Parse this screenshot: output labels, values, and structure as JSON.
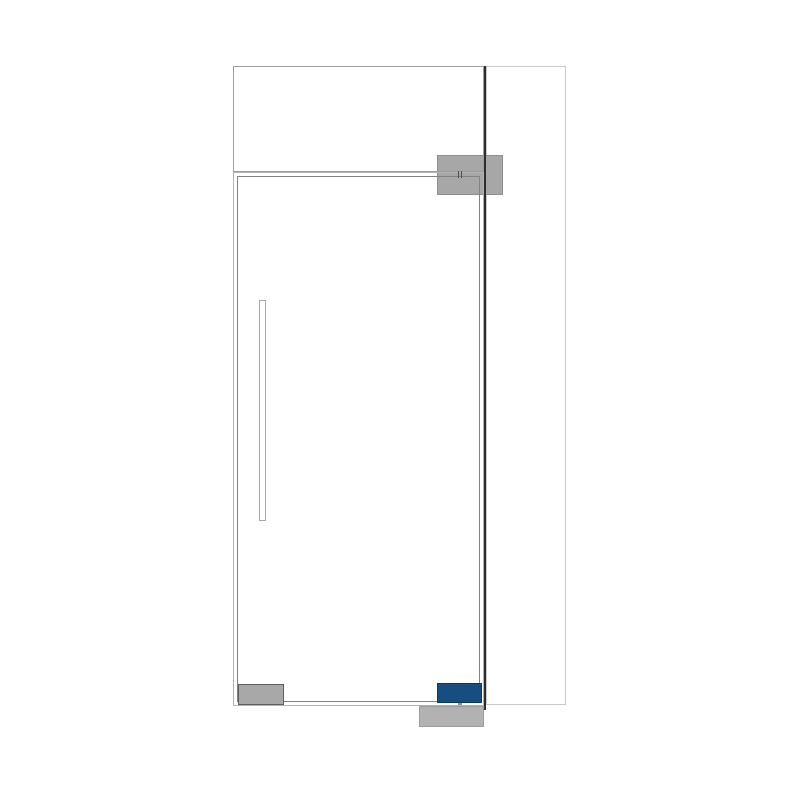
{
  "canvas": {
    "width": 800,
    "height": 800,
    "background": "#ffffff"
  },
  "diagram": {
    "kind": "glass-door-configuration-drawing",
    "accent_color": "#164e7f",
    "line_colors": {
      "outer_frame": "#b2b2b2",
      "door_leaf": "#828282",
      "transom": "#9e9e9e",
      "side_panel": "#c9c9c9",
      "frame_divider": "#2d2d2d"
    },
    "shapes": [
      {
        "name": "side-panel",
        "x": 485.5,
        "y": 66,
        "w": 80,
        "h": 639,
        "fill": "none",
        "stroke": "#c9c9c9",
        "stroke_width": 1.4,
        "interactable": false
      },
      {
        "name": "top-patch-fitting",
        "x": 437,
        "y": 155,
        "w": 66,
        "h": 40,
        "fill": "#a7a7a7",
        "stroke": "#8d8d8d",
        "stroke_width": 1,
        "interactable": true
      },
      {
        "name": "floor-spring-spindle",
        "x": 457.5,
        "y": 698,
        "w": 4,
        "h": 10,
        "fill": "#8f8f8f",
        "stroke": "none",
        "stroke_width": 0,
        "interactable": false
      },
      {
        "name": "floor-spring-fitting",
        "x": 419,
        "y": 706,
        "w": 64.5,
        "h": 21,
        "fill": "#b2b2b2",
        "stroke": "#9c9c9c",
        "stroke_width": 1,
        "interactable": true
      },
      {
        "name": "transom-panel",
        "x": 233,
        "y": 66,
        "w": 251,
        "h": 106,
        "fill": "none",
        "stroke": "#9e9e9e",
        "stroke_width": 1.3,
        "interactable": false
      },
      {
        "name": "door-frame-outline",
        "x": 232.5,
        "y": 171.5,
        "w": 251.5,
        "h": 534,
        "fill": "none",
        "stroke": "#b2b2b2",
        "stroke_width": 1.3,
        "interactable": false
      },
      {
        "name": "door-leaf",
        "x": 237,
        "y": 176,
        "w": 243,
        "h": 526,
        "fill": "none",
        "stroke": "#828282",
        "stroke_width": 1.4,
        "interactable": false
      },
      {
        "name": "bottom-rail-fitting",
        "x": 237.5,
        "y": 683.5,
        "w": 46,
        "h": 21,
        "fill": "#a8a8a8",
        "stroke": "#5e5e5e",
        "stroke_width": 1.4,
        "interactable": true
      },
      {
        "name": "bottom-pivot-fitting-selected",
        "x": 437,
        "y": 683,
        "w": 45,
        "h": 19.5,
        "fill": "#164e7f",
        "stroke": "#0b3a5f",
        "stroke_width": 1.4,
        "interactable": true
      },
      {
        "name": "door-handle-bar",
        "x": 259,
        "y": 300,
        "w": 6.5,
        "h": 221,
        "fill": "#ffffff",
        "stroke": "#a8a8a8",
        "stroke_width": 1.2,
        "interactable": true
      },
      {
        "name": "frame-divider-line",
        "x": 483.8,
        "y": 65.5,
        "w": 2,
        "h": 644,
        "fill": "#2d2d2d",
        "stroke": "none",
        "stroke_width": 0,
        "interactable": false
      },
      {
        "name": "pivot-axis-tick-left",
        "x": 458.2,
        "y": 171,
        "w": 1.2,
        "h": 6.5,
        "fill": "#4f4f4f",
        "stroke": "none",
        "stroke_width": 0,
        "interactable": false
      },
      {
        "name": "pivot-axis-tick-right",
        "x": 460.8,
        "y": 171,
        "w": 1.2,
        "h": 6.5,
        "fill": "#4f4f4f",
        "stroke": "none",
        "stroke_width": 0,
        "interactable": false
      }
    ]
  }
}
